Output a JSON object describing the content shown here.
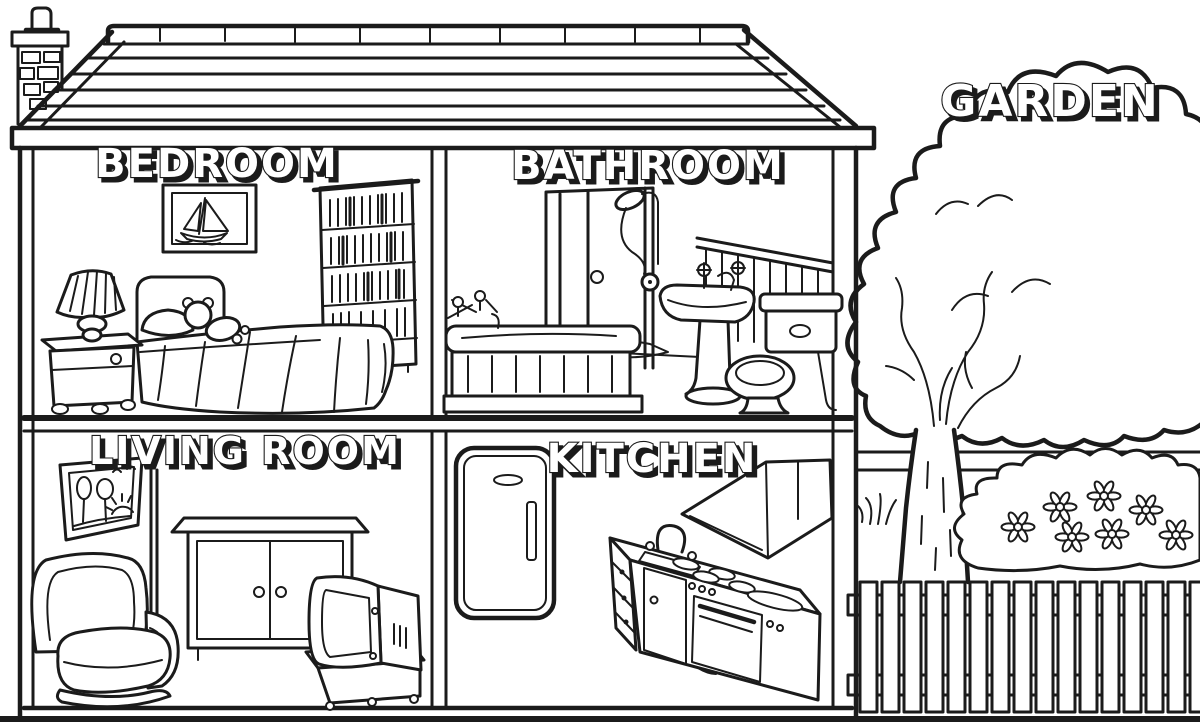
{
  "illustration": {
    "kind": "house cutaway coloring page",
    "palette": {
      "background": "#ffffff",
      "ink": "#1b1b1b",
      "label_fill": "#ffffff",
      "label_shadow": "#1b1b1b"
    },
    "rooms": {
      "bedroom": {
        "label": "BEDROOM",
        "items": [
          "framed sailboat picture",
          "bookshelf",
          "bed",
          "pillow",
          "teddy bear",
          "nightstand",
          "table lamp"
        ]
      },
      "bathroom": {
        "label": "BATHROOM",
        "items": [
          "shower stall",
          "shower head",
          "bathtub",
          "bath taps",
          "pedestal sink",
          "toilet",
          "wall paneling",
          "bath mat"
        ]
      },
      "living_room": {
        "label": "LIVING ROOM",
        "items": [
          "framed picture",
          "floor lamp pole",
          "armchair",
          "cabinet",
          "television",
          "tv stand"
        ]
      },
      "kitchen": {
        "label": "KITCHEN",
        "items": [
          "refrigerator",
          "sink counter",
          "faucet",
          "drawers",
          "stove with burners",
          "oven",
          "range hood"
        ]
      },
      "garden": {
        "label": "GARDEN",
        "items": [
          "tree",
          "flower bush",
          "daisies",
          "grass tufts",
          "picket fence",
          "garden wall"
        ]
      }
    },
    "house_features": [
      "brick chimney",
      "plank roof with ridge caps",
      "eaves beam",
      "two storeys",
      "centre dividing wall",
      "ground line"
    ]
  }
}
